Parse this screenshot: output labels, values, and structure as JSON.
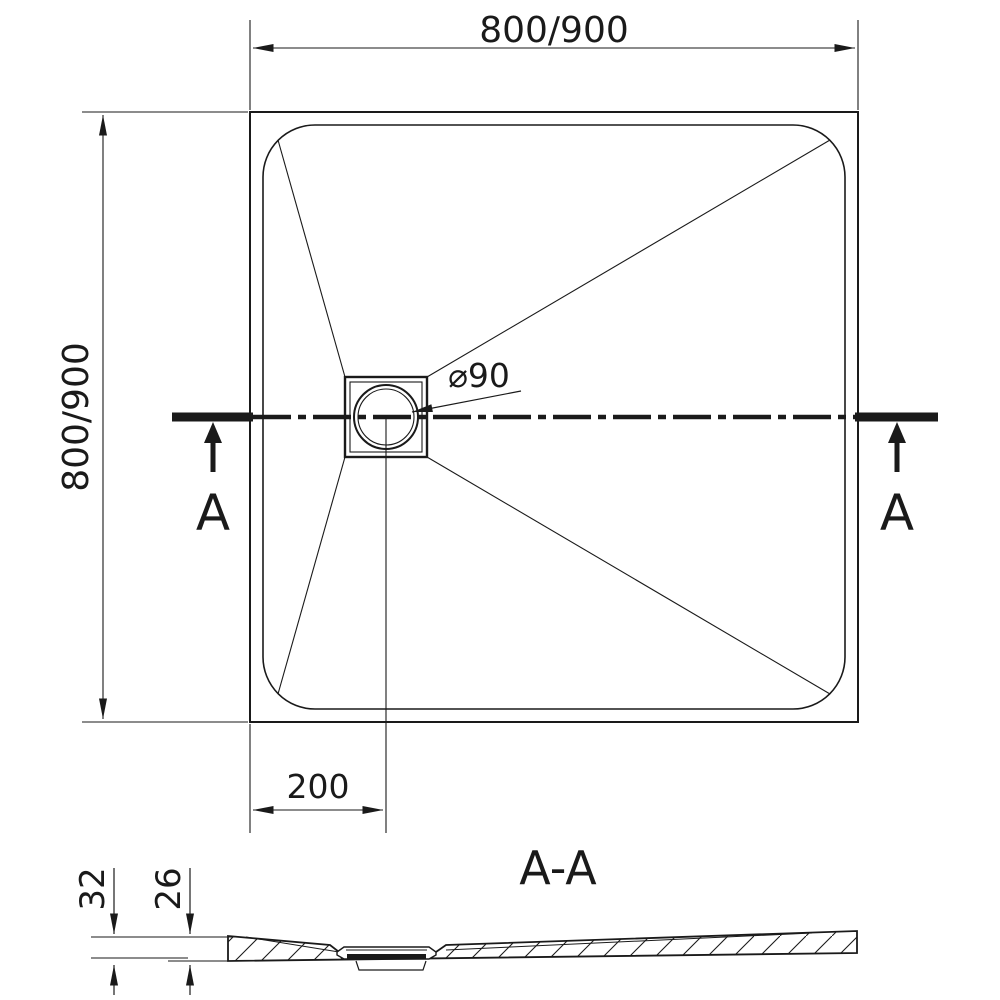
{
  "drawing": {
    "type": "technical-drawing",
    "subject": "square shower tray with drain, top view and cross section",
    "colors": {
      "ink": "#1a1a1a",
      "background": "#ffffff"
    },
    "top_view": {
      "width_dim_label": "800/900",
      "height_dim_label": "800/900",
      "drain_diameter_label": "⌀90",
      "drain_offset_label": "200",
      "section_marker_left": "A",
      "section_marker_right": "A"
    },
    "section_view": {
      "title": "A-A",
      "overall_height_label": "32",
      "base_thickness_label": "26"
    }
  }
}
